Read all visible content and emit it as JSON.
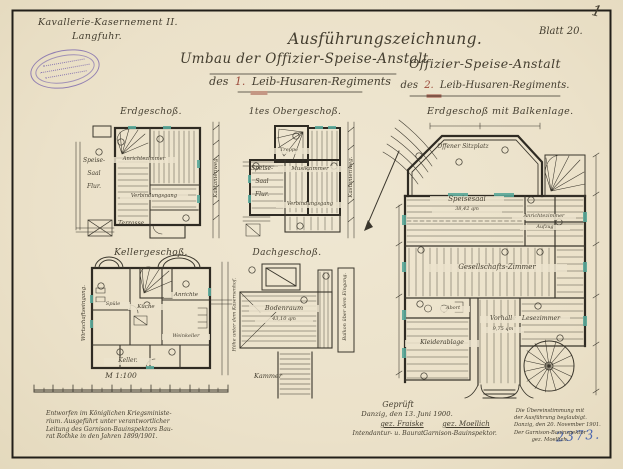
{
  "colors": {
    "paper": "#ece3cd",
    "ink": "#3a362c",
    "stamp": "#7a67ad",
    "window_mark": "#5aa99a",
    "inventory_ink": "#4a66b0",
    "regiment_number": "#9b4a3a"
  },
  "corner_mark": "1",
  "sheet_label": "Blatt 20.",
  "inventory_number": "2373.",
  "header": {
    "site_line1": "Kavallerie-Kasernement II.",
    "site_line2": "Langfuhr.",
    "doc_type": "Ausführungszeichnung.",
    "left_title": "Umbau der Offizier-Speise-Anstalt",
    "left_sub_prefix": "des",
    "left_sub_number": "1.",
    "left_sub_suffix": "Leib-Husaren-Regiments",
    "right_title": "Offizier-Speise-Anstalt",
    "right_sub_prefix": "des",
    "right_sub_number": "2.",
    "right_sub_suffix": "Leib-Husaren-Regiments."
  },
  "plans": {
    "erdgeschoss": {
      "title": "Erdgeschoß.",
      "speise": "Speise-",
      "saal": "Saal",
      "flur": "Flur.",
      "anrichtezimmer": "Anrichtezimmer",
      "verbindungsgang": "Verbindungsgang",
      "terrasse": "Terrasse.",
      "street": "Kastanienweg."
    },
    "obergeschoss": {
      "title": "1tes Obergeschoß.",
      "treppe": "Treppe",
      "speise": "Speise-",
      "saal": "Saal",
      "flur": "Flur.",
      "musikzimmer": "Musikzimmer",
      "verbindungsgang": "Verbindungsgang",
      "street": "Kastanienweg."
    },
    "kellergeschoss": {
      "title": "Kellergeschoß.",
      "side_left": "Wirtschaftseingang.",
      "spuele": "Spüle",
      "kueche": "Küche",
      "anrichte": "Anrichte",
      "weinkeller": "Weinkeller",
      "keller": "Keller.",
      "side_right": "Höhe unter dem Kasernenhof."
    },
    "dachgeschoss": {
      "title": "Dachgeschoß.",
      "bodenraum": "Bodenraum",
      "bodenraum_area": "43,10 qm",
      "kammer": "Kammer",
      "side_right": "Balkon über dem Eingang."
    },
    "balkenlage": {
      "title": "Erdgeschoß mit Balkenlage.",
      "sitzplatz": "Offener Sitzplatz",
      "speisesaal": "Speisesaal",
      "speisesaal_area": "38,42 qm",
      "anrichtezimmer": "Anrichtezimmer",
      "aufzug": "Aufzug",
      "gesellschaftszimmer": "Gesellschafts-Zimmer",
      "abort": "Abort",
      "vorhalle": "Vorhalle",
      "vorhalle_area": "9,75 qm",
      "lesezimmer": "Lesezimmer",
      "kleiderablage": "Kleiderablage"
    }
  },
  "scale": {
    "label": "M 1:100"
  },
  "notes": {
    "design_note": [
      "Entworfen im Königlichen Kriegsministe-",
      "rium. Ausgeführt unter verantwortlicher",
      "Leitung des Garnison-Bauinspektors Bau-",
      "rat Rothke in den Jahren 1899/1901."
    ],
    "approval": {
      "heading": "Geprüft",
      "place_date": "Danzig, den 13. Juni 1900.",
      "sig_left": "gez. Fraiske",
      "sig_left_title": "Intendantur- u. Baurat.",
      "sig_right": "gez. Moellich",
      "sig_right_title": "Garnison-Bauinspektor."
    },
    "certification": [
      "Die Übereinstimmung mit",
      "der Ausführung beglaubigt.",
      "Danzig, den 20. November 1901.",
      "Der Garnison-Bauinspektor",
      "gez. Moellich."
    ]
  }
}
